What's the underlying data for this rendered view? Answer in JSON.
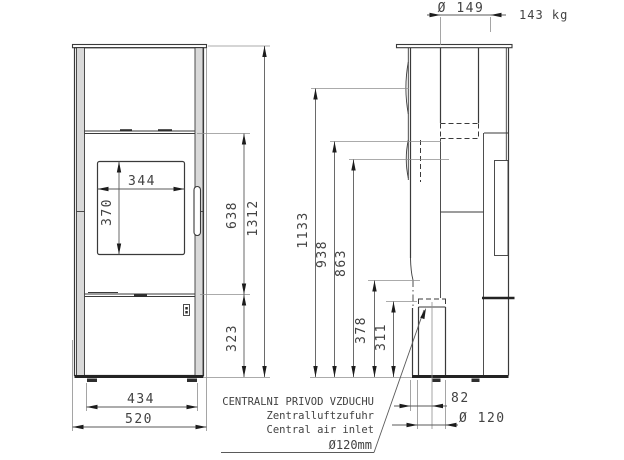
{
  "drawing": {
    "weight": "143 kg",
    "front_view": {
      "window_width": "344",
      "window_height": "370",
      "upper_body_height": "638",
      "total_height": "1312",
      "base_section_height": "323",
      "base_width": "434",
      "total_width": "520"
    },
    "side_view": {
      "flue_diameter": "Ø 149",
      "rear_outlet_height": "1133",
      "height_938": "938",
      "height_863": "863",
      "height_378": "378",
      "height_311": "311",
      "air_inlet_setback": "82",
      "air_inlet_pipe_diameter": "Ø 120"
    },
    "air_inlet_note": {
      "cs": "CENTRALNI PRIVOD VZDUCHU",
      "de": "Zentralluftzufuhr",
      "en": "Central air inlet",
      "diameter": "Ø120mm"
    }
  }
}
